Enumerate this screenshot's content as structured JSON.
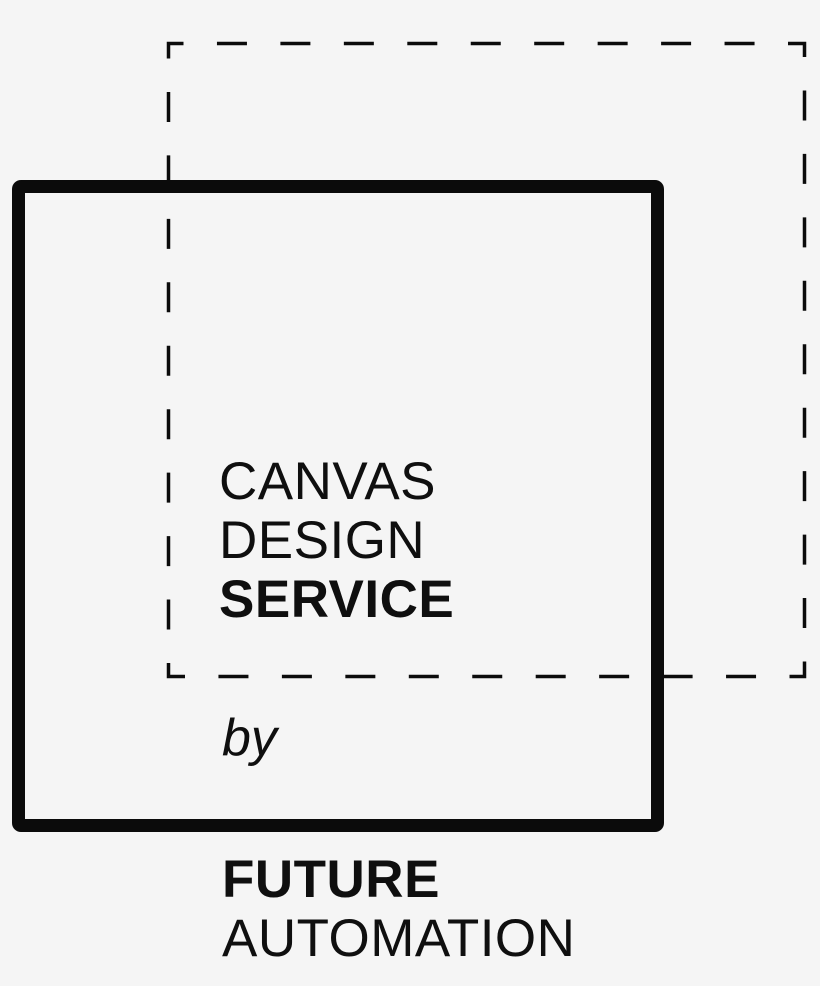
{
  "page": {
    "background_color": "#f5f5f5",
    "ink_color": "#0f0f0f"
  },
  "logo": {
    "title_lines": [
      {
        "text": "CANVAS",
        "weight": "light"
      },
      {
        "text": "DESIGN",
        "weight": "regular"
      },
      {
        "text": "SERVICE",
        "weight": "bold"
      }
    ],
    "byline": "by",
    "brand_lines": [
      {
        "text": "FUTURE",
        "weight": "bold"
      },
      {
        "text": "AUTOMATION",
        "weight": "light"
      }
    ],
    "shapes": {
      "dashed_square": {
        "stroke_color": "#0b0b0b",
        "stroke_width": 3.5,
        "dash_length": 30,
        "gap_length": 33.45
      },
      "solid_square": {
        "stroke_color": "#0b0b0b",
        "stroke_width": 13
      }
    }
  }
}
